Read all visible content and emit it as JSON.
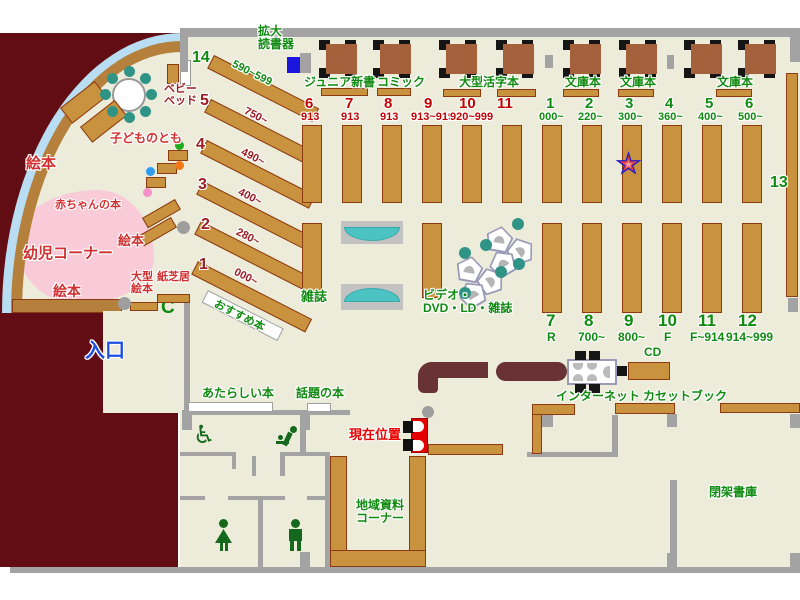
{
  "map_title": "図書館フロアマップ",
  "colors": {
    "green": "#118a11",
    "red": "#d03030",
    "dred": "#9c1d23",
    "tred": "#c00404",
    "bred": "#e80000",
    "blue": "#1d4fe0",
    "shelf": "#c8923f",
    "shelf_border": "#8b3a12",
    "wall": "#a3a3a3",
    "outside": "#620d13",
    "counter": "#693336",
    "floor": "#edecdb",
    "pink": "#f9cbd9",
    "light_blue": "#b9ddf2",
    "teal": "#2f9486",
    "bench_teal": "#4cc3c3",
    "table_brown": "#a5613c",
    "star_blue": "#1b1bd0",
    "star_red": "#e23b3b"
  },
  "icons": {
    "phone_glyph": "C",
    "wheelchair_glyph": "♿"
  },
  "labels": [
    {
      "n": "kakudai-dokushoki-label",
      "t": "拡大\n読書器",
      "x": 258,
      "y": 25,
      "s": 12,
      "c": "green"
    },
    {
      "n": "junior-shinsho-label",
      "t": "ジュニア新書",
      "x": 304,
      "y": 76,
      "s": 12,
      "c": "green"
    },
    {
      "n": "comic-label",
      "t": "コミック",
      "x": 377,
      "y": 76,
      "s": 12,
      "c": "green"
    },
    {
      "n": "ogata-katsuji-label",
      "t": "大型活字本",
      "x": 459,
      "y": 76,
      "s": 12,
      "c": "green"
    },
    {
      "n": "bunkobon-label-1",
      "t": "文庫本",
      "x": 565,
      "y": 76,
      "s": 12,
      "c": "green"
    },
    {
      "n": "bunkobon-label-2",
      "t": "文庫本",
      "x": 620,
      "y": 76,
      "s": 12,
      "c": "green"
    },
    {
      "n": "bunkobon-label-3",
      "t": "文庫本",
      "x": 717,
      "y": 76,
      "s": 12,
      "c": "green"
    },
    {
      "n": "shelf-14-num",
      "t": "14",
      "x": 192,
      "y": 49,
      "s": 16,
      "c": "green"
    },
    {
      "n": "shelf-14-range",
      "t": "590~599",
      "x": 235,
      "y": 59,
      "s": 11,
      "c": "green",
      "r": 27
    },
    {
      "n": "shelf-5-num",
      "t": "5",
      "x": 200,
      "y": 92,
      "s": 16,
      "c": "dred"
    },
    {
      "n": "shelf-5-range",
      "t": "750~",
      "x": 247,
      "y": 106,
      "s": 11,
      "c": "dred",
      "r": 27
    },
    {
      "n": "shelf-4-num",
      "t": "4",
      "x": 196,
      "y": 136,
      "s": 16,
      "c": "dred"
    },
    {
      "n": "shelf-4-range",
      "t": "490~",
      "x": 244,
      "y": 147,
      "s": 11,
      "c": "dred",
      "r": 27
    },
    {
      "n": "shelf-3-num",
      "t": "3",
      "x": 198,
      "y": 176,
      "s": 16,
      "c": "dred"
    },
    {
      "n": "shelf-3-range",
      "t": "400~",
      "x": 241,
      "y": 187,
      "s": 11,
      "c": "dred",
      "r": 27
    },
    {
      "n": "shelf-2-num",
      "t": "2",
      "x": 201,
      "y": 216,
      "s": 16,
      "c": "dred"
    },
    {
      "n": "shelf-2-range",
      "t": "280~",
      "x": 239,
      "y": 227,
      "s": 11,
      "c": "dred",
      "r": 27
    },
    {
      "n": "shelf-1-num",
      "t": "1",
      "x": 199,
      "y": 256,
      "s": 16,
      "c": "dred"
    },
    {
      "n": "shelf-1-range",
      "t": "000~",
      "x": 237,
      "y": 267,
      "s": 11,
      "c": "dred",
      "r": 27
    },
    {
      "n": "osusume-bon-label",
      "t": "おすすめ本",
      "x": 217,
      "y": 299,
      "s": 11,
      "c": "green",
      "r": 27
    },
    {
      "n": "sec6-num",
      "t": "6",
      "x": 305,
      "y": 96,
      "s": 15,
      "c": "tred"
    },
    {
      "n": "sec6-range",
      "t": "913",
      "x": 301,
      "y": 112,
      "s": 11,
      "c": "tred"
    },
    {
      "n": "sec7-num",
      "t": "7",
      "x": 345,
      "y": 96,
      "s": 15,
      "c": "tred"
    },
    {
      "n": "sec7-range",
      "t": "913",
      "x": 341,
      "y": 112,
      "s": 11,
      "c": "tred"
    },
    {
      "n": "sec8-num",
      "t": "8",
      "x": 384,
      "y": 96,
      "s": 15,
      "c": "tred"
    },
    {
      "n": "sec8-range",
      "t": "913",
      "x": 380,
      "y": 112,
      "s": 11,
      "c": "tred"
    },
    {
      "n": "sec9-num",
      "t": "9",
      "x": 424,
      "y": 96,
      "s": 15,
      "c": "tred"
    },
    {
      "n": "sec9-range",
      "t": "913~919",
      "x": 411,
      "y": 112,
      "s": 11,
      "c": "tred"
    },
    {
      "n": "sec10-num",
      "t": "10",
      "x": 459,
      "y": 96,
      "s": 15,
      "c": "tred"
    },
    {
      "n": "sec10-range",
      "t": "920~999",
      "x": 450,
      "y": 112,
      "s": 11,
      "c": "tred"
    },
    {
      "n": "sec11-num",
      "t": "11",
      "x": 497,
      "y": 96,
      "s": 15,
      "c": "tred"
    },
    {
      "n": "sec1g-num",
      "t": "1",
      "x": 546,
      "y": 96,
      "s": 15,
      "c": "green"
    },
    {
      "n": "sec1g-range",
      "t": "000~",
      "x": 539,
      "y": 112,
      "s": 11,
      "c": "green"
    },
    {
      "n": "sec2g-num",
      "t": "2",
      "x": 585,
      "y": 96,
      "s": 15,
      "c": "green"
    },
    {
      "n": "sec2g-range",
      "t": "220~",
      "x": 578,
      "y": 112,
      "s": 11,
      "c": "green"
    },
    {
      "n": "sec3g-num",
      "t": "3",
      "x": 625,
      "y": 96,
      "s": 15,
      "c": "green"
    },
    {
      "n": "sec3g-range",
      "t": "300~",
      "x": 618,
      "y": 112,
      "s": 11,
      "c": "green"
    },
    {
      "n": "sec4g-num",
      "t": "4",
      "x": 665,
      "y": 96,
      "s": 15,
      "c": "green"
    },
    {
      "n": "sec4g-range",
      "t": "360~",
      "x": 658,
      "y": 112,
      "s": 11,
      "c": "green"
    },
    {
      "n": "sec5g-num",
      "t": "5",
      "x": 705,
      "y": 96,
      "s": 15,
      "c": "green"
    },
    {
      "n": "sec5g-range",
      "t": "400~",
      "x": 698,
      "y": 112,
      "s": 11,
      "c": "green"
    },
    {
      "n": "sec6g-num",
      "t": "6",
      "x": 745,
      "y": 96,
      "s": 15,
      "c": "green"
    },
    {
      "n": "sec6g-range",
      "t": "500~",
      "x": 738,
      "y": 112,
      "s": 11,
      "c": "green"
    },
    {
      "n": "shelf-13-num",
      "t": "13",
      "x": 770,
      "y": 174,
      "s": 16,
      "c": "green"
    },
    {
      "n": "sec7b-num",
      "t": "7",
      "x": 546,
      "y": 312,
      "s": 17,
      "c": "green"
    },
    {
      "n": "sec7b-range",
      "t": "R",
      "x": 547,
      "y": 331,
      "s": 12,
      "c": "green"
    },
    {
      "n": "sec8b-num",
      "t": "8",
      "x": 584,
      "y": 312,
      "s": 17,
      "c": "green"
    },
    {
      "n": "sec8b-range",
      "t": "700~",
      "x": 578,
      "y": 331,
      "s": 12,
      "c": "green"
    },
    {
      "n": "sec9b-num",
      "t": "9",
      "x": 624,
      "y": 312,
      "s": 17,
      "c": "green"
    },
    {
      "n": "sec9b-range",
      "t": "800~",
      "x": 618,
      "y": 331,
      "s": 12,
      "c": "green"
    },
    {
      "n": "sec10b-num",
      "t": "10",
      "x": 658,
      "y": 312,
      "s": 17,
      "c": "green"
    },
    {
      "n": "sec10b-range",
      "t": "F",
      "x": 664,
      "y": 331,
      "s": 12,
      "c": "green"
    },
    {
      "n": "sec11b-num",
      "t": "11",
      "x": 698,
      "y": 312,
      "s": 17,
      "c": "green"
    },
    {
      "n": "sec11b-range",
      "t": "F~914",
      "x": 690,
      "y": 331,
      "s": 12,
      "c": "green"
    },
    {
      "n": "sec12b-num",
      "t": "12",
      "x": 738,
      "y": 312,
      "s": 17,
      "c": "green"
    },
    {
      "n": "sec12b-range",
      "t": "914~999",
      "x": 726,
      "y": 331,
      "s": 12,
      "c": "green"
    },
    {
      "n": "zasshi-label",
      "t": "雑誌",
      "x": 301,
      "y": 290,
      "s": 13,
      "c": "green"
    },
    {
      "n": "video-dvd-label",
      "t": "ビデオ・\nDVD・LD・雑誌",
      "x": 423,
      "y": 289,
      "s": 12,
      "c": "green"
    },
    {
      "n": "ehon-label-top",
      "t": "絵本",
      "x": 26,
      "y": 156,
      "s": 15,
      "c": "red"
    },
    {
      "n": "kodomo-no-tomo-label",
      "t": "子どものとも",
      "x": 110,
      "y": 132,
      "s": 12,
      "c": "red"
    },
    {
      "n": "baby-bed-label",
      "t": "ベビー\nベッド",
      "x": 164,
      "y": 84,
      "s": 11,
      "c": "dred"
    },
    {
      "n": "akachan-no-hon-label",
      "t": "赤ちゃんの本",
      "x": 55,
      "y": 200,
      "s": 11,
      "c": "red"
    },
    {
      "n": "youji-corner-label",
      "t": "幼児コーナー",
      "x": 23,
      "y": 246,
      "s": 15,
      "c": "red"
    },
    {
      "n": "ehon-label-mid",
      "t": "絵本",
      "x": 118,
      "y": 234,
      "s": 13,
      "c": "red"
    },
    {
      "n": "ehon-label-bottom",
      "t": "絵本",
      "x": 53,
      "y": 284,
      "s": 14,
      "c": "red"
    },
    {
      "n": "ogata-ehon-label",
      "t": "大型\n絵本",
      "x": 131,
      "y": 272,
      "s": 11,
      "c": "red"
    },
    {
      "n": "kamishibai-label",
      "t": "紙芝居",
      "x": 157,
      "y": 272,
      "s": 11,
      "c": "red"
    },
    {
      "n": "entrance-label",
      "t": "入口",
      "x": 85,
      "y": 341,
      "s": 20,
      "c": "blue"
    },
    {
      "n": "atarashii-hon-label",
      "t": "あたらしい本",
      "x": 202,
      "y": 387,
      "s": 12,
      "c": "green"
    },
    {
      "n": "wadai-no-hon-label",
      "t": "話題の本",
      "x": 296,
      "y": 387,
      "s": 12,
      "c": "green"
    },
    {
      "n": "current-location-label",
      "t": "現在位置",
      "x": 349,
      "y": 428,
      "s": 13,
      "c": "bred"
    },
    {
      "n": "chiiki-shiryo-label",
      "t": "地域資料\nコーナー",
      "x": 356,
      "y": 499,
      "s": 12,
      "c": "green"
    },
    {
      "n": "internet-label",
      "t": "インターネット",
      "x": 556,
      "y": 390,
      "s": 12,
      "c": "green"
    },
    {
      "n": "cassette-book-label",
      "t": "カセットブック",
      "x": 643,
      "y": 390,
      "s": 12,
      "c": "green"
    },
    {
      "n": "cd-label",
      "t": "CD",
      "x": 644,
      "y": 346,
      "s": 12,
      "c": "green"
    },
    {
      "n": "heika-shoko-label",
      "t": "閉架書庫",
      "x": 709,
      "y": 486,
      "s": 12,
      "c": "green"
    }
  ],
  "furniture": {
    "brown_shelves": [
      [
        214,
        55,
        118,
        15,
        27
      ],
      [
        211,
        99,
        120,
        15,
        27
      ],
      [
        207,
        140,
        122,
        15,
        27
      ],
      [
        203,
        181,
        124,
        15,
        27
      ],
      [
        201,
        221,
        126,
        15,
        27
      ],
      [
        198,
        261,
        128,
        15,
        27
      ],
      [
        321,
        88,
        47,
        8
      ],
      [
        377,
        88,
        34,
        8
      ],
      [
        443,
        89,
        38,
        8
      ],
      [
        497,
        89,
        39,
        8
      ],
      [
        563,
        89,
        36,
        8
      ],
      [
        618,
        89,
        36,
        8
      ],
      [
        716,
        89,
        36,
        8
      ],
      [
        302,
        125,
        20,
        78
      ],
      [
        342,
        125,
        20,
        78
      ],
      [
        382,
        125,
        20,
        78
      ],
      [
        422,
        125,
        20,
        78
      ],
      [
        462,
        125,
        20,
        78
      ],
      [
        502,
        125,
        20,
        78
      ],
      [
        542,
        125,
        20,
        78
      ],
      [
        582,
        125,
        20,
        78
      ],
      [
        622,
        125,
        20,
        78
      ],
      [
        662,
        125,
        20,
        78
      ],
      [
        702,
        125,
        20,
        78
      ],
      [
        742,
        125,
        20,
        78
      ],
      [
        302,
        223,
        20,
        75
      ],
      [
        422,
        223,
        20,
        75
      ],
      [
        542,
        223,
        20,
        90
      ],
      [
        582,
        223,
        20,
        90
      ],
      [
        622,
        223,
        20,
        90
      ],
      [
        662,
        223,
        20,
        90
      ],
      [
        702,
        223,
        20,
        90
      ],
      [
        742,
        223,
        20,
        90
      ],
      [
        786,
        73,
        12,
        224
      ],
      [
        628,
        362,
        42,
        18
      ],
      [
        615,
        403,
        60,
        11
      ],
      [
        720,
        403,
        80,
        10
      ],
      [
        532,
        404,
        10,
        50
      ],
      [
        532,
        404,
        43,
        11
      ],
      [
        428,
        444,
        75,
        11
      ],
      [
        330,
        456,
        17,
        111
      ],
      [
        409,
        456,
        17,
        111
      ],
      [
        330,
        550,
        96,
        17
      ],
      [
        130,
        302,
        28,
        9
      ],
      [
        157,
        294,
        33,
        9
      ],
      [
        167,
        64,
        12,
        20
      ],
      [
        60,
        108,
        44,
        20,
        -38
      ],
      [
        80,
        127,
        44,
        20,
        -38
      ],
      [
        142,
        218,
        38,
        12,
        -30
      ],
      [
        138,
        236,
        38,
        12,
        -30
      ],
      [
        168,
        150,
        20,
        11
      ],
      [
        157,
        163,
        20,
        11
      ],
      [
        146,
        177,
        20,
        11
      ]
    ],
    "white_shelves": [
      [
        188,
        402,
        85,
        10
      ],
      [
        307,
        403,
        24,
        9
      ],
      [
        208,
        290,
        85,
        14,
        27
      ]
    ],
    "walls": [
      [
        182,
        28,
        618,
        9
      ],
      [
        180,
        28,
        8,
        44
      ],
      [
        790,
        37,
        10,
        25
      ],
      [
        10,
        567,
        790,
        6
      ],
      [
        184,
        298,
        6,
        114
      ],
      [
        182,
        410,
        168,
        5
      ],
      [
        182,
        415,
        10,
        15
      ],
      [
        300,
        410,
        10,
        20
      ],
      [
        300,
        430,
        6,
        24
      ],
      [
        180,
        452,
        56,
        4
      ],
      [
        232,
        452,
        4,
        17
      ],
      [
        252,
        456,
        4,
        20
      ],
      [
        280,
        452,
        50,
        4
      ],
      [
        280,
        456,
        5,
        20
      ],
      [
        180,
        496,
        25,
        4
      ],
      [
        228,
        496,
        57,
        4
      ],
      [
        307,
        496,
        23,
        4
      ],
      [
        258,
        500,
        5,
        67
      ],
      [
        325,
        453,
        5,
        114
      ],
      [
        300,
        552,
        10,
        15
      ],
      [
        527,
        452,
        90,
        5
      ],
      [
        612,
        415,
        6,
        42
      ],
      [
        542,
        413,
        11,
        14
      ],
      [
        670,
        480,
        7,
        87
      ],
      [
        667,
        553,
        10,
        14
      ],
      [
        790,
        553,
        10,
        14
      ],
      [
        667,
        414,
        10,
        13
      ],
      [
        790,
        414,
        10,
        14
      ],
      [
        788,
        298,
        10,
        14
      ],
      [
        300,
        53,
        11,
        20
      ],
      [
        545,
        55,
        8,
        13
      ],
      [
        667,
        55,
        7,
        14
      ]
    ],
    "tables_x": [
      318,
      372,
      438,
      495,
      562,
      618,
      683,
      737
    ],
    "pentagons": [
      [
        486,
        226,
        10
      ],
      [
        508,
        238,
        55
      ],
      [
        489,
        250,
        -30
      ],
      [
        456,
        256,
        10
      ],
      [
        478,
        268,
        55
      ],
      [
        459,
        281,
        -30
      ]
    ],
    "dots": [
      [
        146,
        89,
        11,
        "teal"
      ],
      [
        140,
        106,
        11,
        "teal"
      ],
      [
        124,
        112,
        11,
        "teal"
      ],
      [
        107,
        106,
        11,
        "teal"
      ],
      [
        100,
        89,
        11,
        "teal"
      ],
      [
        107,
        73,
        11,
        "teal"
      ],
      [
        124,
        66,
        11,
        "teal"
      ],
      [
        140,
        73,
        11,
        "teal"
      ],
      [
        512,
        218,
        12,
        "teal"
      ],
      [
        480,
        239,
        12,
        "teal"
      ],
      [
        459,
        247,
        12,
        "teal"
      ],
      [
        513,
        258,
        12,
        "teal"
      ],
      [
        495,
        266,
        12,
        "teal"
      ],
      [
        459,
        287,
        12,
        "teal"
      ],
      [
        175,
        141,
        9,
        "green2"
      ],
      [
        175,
        161,
        9,
        "orange"
      ],
      [
        146,
        167,
        9,
        "blue2"
      ],
      [
        143,
        188,
        9,
        "pink2"
      ],
      [
        177,
        221,
        13,
        "gray"
      ],
      [
        118,
        297,
        13,
        "gray"
      ],
      [
        422,
        406,
        12,
        "gray"
      ]
    ],
    "dot_colors": {
      "teal": "#2f9486",
      "green2": "#1faa1f",
      "orange": "#f07818",
      "blue2": "#2e9df0",
      "pink2": "#f590c8",
      "gray": "#9e9e9e"
    }
  }
}
